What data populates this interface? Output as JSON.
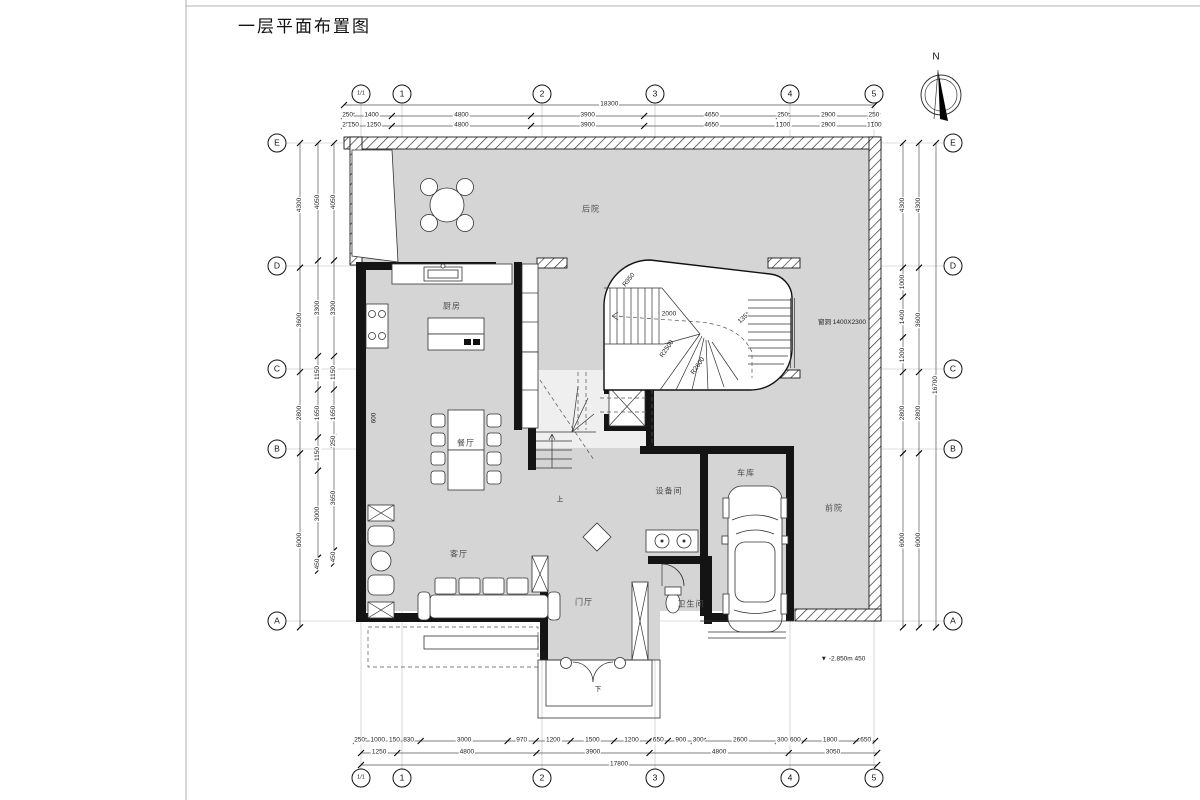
{
  "title": "一层平面布置图",
  "compass": {
    "label": "N"
  },
  "grid": {
    "cols": [
      "1/1",
      "1",
      "2",
      "3",
      "4",
      "5"
    ],
    "rows": [
      "E",
      "D",
      "C",
      "B",
      "A"
    ],
    "col_x": [
      361,
      402,
      542,
      655,
      790,
      874
    ],
    "row_y": [
      143,
      266,
      369,
      449,
      621
    ],
    "top_bubble_y": 94,
    "bottom_bubble_y": 778,
    "left_bubble_x": 277,
    "right_bubble_x": 953
  },
  "dimensions": {
    "rows": [
      {
        "name": "top-overall",
        "y": 105,
        "x0": 344,
        "values": [
          18300
        ]
      },
      {
        "name": "top-row-1",
        "y": 116,
        "x0": 344,
        "values": [
          250,
          1400,
          4800,
          3900,
          4650,
          250,
          2900,
          250
        ]
      },
      {
        "name": "top-row-2",
        "y": 126,
        "x0": 344,
        "values": [
          250,
          150,
          1250,
          4800,
          3900,
          4650,
          150,
          100,
          2900,
          150,
          100
        ]
      },
      {
        "name": "bottom-row-1",
        "y": 741,
        "x0": 356,
        "values": [
          250,
          1000,
          150,
          830,
          3000,
          970,
          1200,
          1500,
          1200,
          650,
          900,
          300,
          2600,
          300,
          600,
          1800,
          650
        ]
      },
      {
        "name": "bottom-row-2",
        "y": 753,
        "x0": 361,
        "values": [
          1250,
          4800,
          3900,
          4800,
          3050
        ]
      },
      {
        "name": "bottom-overall",
        "y": 765,
        "x0": 361,
        "values": [
          17800
        ]
      }
    ],
    "cols": [
      {
        "name": "left-col-outer",
        "x": 300,
        "y0": 143,
        "values": [
          4300,
          3600,
          2800,
          6000
        ]
      },
      {
        "name": "left-col-mid",
        "x": 318,
        "y0": 143,
        "values": [
          4050,
          3300,
          1150,
          1650,
          1150,
          3000,
          450
        ]
      },
      {
        "name": "left-col-inner",
        "x": 334,
        "y0": 143,
        "values": [
          4050,
          3300,
          1150,
          1650,
          250,
          3650,
          450
        ]
      },
      {
        "name": "right-col-inner",
        "x": 903,
        "y0": 143,
        "values": [
          4300,
          1000,
          1400,
          1200,
          2800,
          6000
        ]
      },
      {
        "name": "right-col-outer",
        "x": 919,
        "y0": 143,
        "values": [
          4300,
          3600,
          2800,
          6000
        ]
      },
      {
        "name": "right-overall",
        "x": 936,
        "y0": 143,
        "values": [
          16700
        ]
      }
    ]
  },
  "rooms": [
    {
      "name": "后院",
      "x": 591,
      "y": 209
    },
    {
      "name": "厨房",
      "x": 452,
      "y": 306
    },
    {
      "name": "餐厅",
      "x": 466,
      "y": 443
    },
    {
      "name": "客厅",
      "x": 459,
      "y": 554
    },
    {
      "name": "门厅",
      "x": 584,
      "y": 602
    },
    {
      "name": "设备间",
      "x": 669,
      "y": 491
    },
    {
      "name": "车库",
      "x": 746,
      "y": 473
    },
    {
      "name": "卫生间",
      "x": 691,
      "y": 604
    },
    {
      "name": "前院",
      "x": 834,
      "y": 508
    }
  ],
  "annotations": [
    {
      "text": "R950",
      "x": 629,
      "y": 280,
      "rot": -52
    },
    {
      "text": "2000",
      "x": 669,
      "y": 314,
      "rot": 0
    },
    {
      "text": "135°",
      "x": 744,
      "y": 318,
      "rot": -42
    },
    {
      "text": "R2500",
      "x": 667,
      "y": 349,
      "rot": -55
    },
    {
      "text": "R2600",
      "x": 698,
      "y": 366,
      "rot": -55
    },
    {
      "text": "窗洞 1400X2300",
      "x": 842,
      "y": 321,
      "rot": 0
    },
    {
      "text": "▼ -2.850m 450",
      "x": 843,
      "y": 659,
      "rot": 0
    },
    {
      "text": "600",
      "x": 374,
      "y": 418,
      "rot": -90
    },
    {
      "text": "上",
      "x": 560,
      "y": 498,
      "rot": 0
    },
    {
      "text": "下",
      "x": 598,
      "y": 688,
      "rot": 0
    }
  ]
}
